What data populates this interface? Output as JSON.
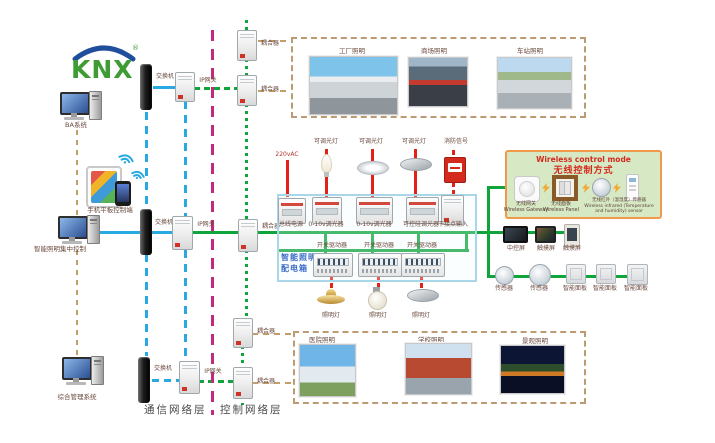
{
  "logo": {
    "text": "KNX",
    "reg": "®"
  },
  "layers": {
    "comm": "通信网络层",
    "ctrl": "控制网络层"
  },
  "left": {
    "pc_top": "BA系统",
    "mobile": "手机平板控制端",
    "pc_mid": "智能照明集中控制",
    "pc_bottom": "综合管理系统"
  },
  "comm_net": {
    "switch_top": "交换机",
    "gateway_top": "IP网关",
    "switch_mid": "交换机",
    "gateway_mid": "IP网关",
    "switch_bottom": "交换机",
    "gateway_bottom": "IP网关"
  },
  "couplers": {
    "top1": "耦合器",
    "top2": "耦合器",
    "mid": "耦合器",
    "bottom1": "耦合器",
    "bottom2": "耦合器"
  },
  "top_photos": [
    {
      "caption": "工厂照明"
    },
    {
      "caption": "商场照明"
    },
    {
      "caption": "车站照明"
    }
  ],
  "bottom_photos": [
    {
      "caption": "医院照明"
    },
    {
      "caption": "学校照明"
    },
    {
      "caption": "景观照明"
    }
  ],
  "dist_box": {
    "name_line1": "智能照明",
    "name_line2": "配电箱",
    "power_in": "220vAC",
    "loads": [
      "可调光灯",
      "可调光灯",
      "可调光灯",
      "消防信号"
    ],
    "devices": [
      "总线电源",
      "0-10v调光器",
      "0-10v调光器",
      "可控硅调光器",
      "干接点输入"
    ],
    "actuators": [
      "开关驱动器",
      "开关驱动器",
      "开关驱动器"
    ],
    "lamps": [
      "照明灯",
      "照明灯",
      "照明灯"
    ]
  },
  "wireless": {
    "title_en": "Wireless control mode",
    "title_zh": "无线控制方式",
    "gateway_zh": "无线网关",
    "gateway_en": "Wireless Gateway",
    "panel_zh": "无线面板",
    "panel_en": "Wireless Panel",
    "sensor_zh": "无线红外（温湿度）传感器",
    "sensor_en": "Wireless infrared (Temperature and humidity) sensor"
  },
  "control_devices": {
    "screens": [
      "中控屏",
      "触摸屏",
      "触摸屏"
    ],
    "sensors": [
      "传感器",
      "传感器"
    ],
    "panels": [
      "智能面板",
      "智能面板",
      "智能面板"
    ]
  },
  "colors": {
    "bus_green": "#0FA43C",
    "comm_blue": "#29A9E1",
    "backbone_magenta": "#C12B7B",
    "load_red": "#E32119",
    "link_tan": "#C29E6A",
    "wireless_bg": "#D6E9C4",
    "wireless_border": "#F0994A",
    "distbox_border": "#A9D7E8",
    "distbox_label": "#3A6BC8"
  }
}
